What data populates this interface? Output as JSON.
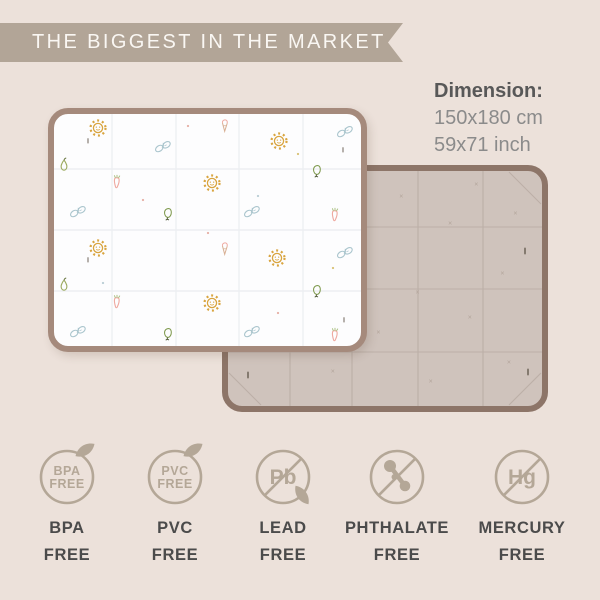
{
  "banner": {
    "title": "THE BIGGEST IN THE MARKET"
  },
  "dimension": {
    "title": "Dimension:",
    "metric": "150x180 cm",
    "imperial": "59x71 inch"
  },
  "mats": {
    "front": {
      "description": "white play mat front side with pastel pattern",
      "pattern_icons": [
        {
          "type": "sun",
          "x": 50,
          "y": 20
        },
        {
          "type": "cone",
          "x": 177,
          "y": 17
        },
        {
          "type": "sun",
          "x": 231,
          "y": 33
        },
        {
          "type": "butterfly",
          "x": 297,
          "y": 24
        },
        {
          "type": "butterfly",
          "x": 115,
          "y": 39
        },
        {
          "type": "pear",
          "x": 16,
          "y": 57
        },
        {
          "type": "balloon",
          "x": 269,
          "y": 64
        },
        {
          "type": "carrot",
          "x": 69,
          "y": 74
        },
        {
          "type": "sun",
          "x": 164,
          "y": 75
        },
        {
          "type": "butterfly",
          "x": 30,
          "y": 104
        },
        {
          "type": "balloon",
          "x": 120,
          "y": 107
        },
        {
          "type": "butterfly",
          "x": 204,
          "y": 104
        },
        {
          "type": "carrot",
          "x": 287,
          "y": 107
        },
        {
          "type": "sun",
          "x": 50,
          "y": 140
        },
        {
          "type": "cone",
          "x": 177,
          "y": 140
        },
        {
          "type": "sun",
          "x": 229,
          "y": 150
        },
        {
          "type": "butterfly",
          "x": 297,
          "y": 145
        },
        {
          "type": "pear",
          "x": 16,
          "y": 177
        },
        {
          "type": "balloon",
          "x": 269,
          "y": 184
        },
        {
          "type": "carrot",
          "x": 69,
          "y": 194
        },
        {
          "type": "sun",
          "x": 164,
          "y": 195
        },
        {
          "type": "butterfly",
          "x": 30,
          "y": 224
        },
        {
          "type": "balloon",
          "x": 120,
          "y": 227
        },
        {
          "type": "butterfly",
          "x": 204,
          "y": 224
        },
        {
          "type": "carrot",
          "x": 287,
          "y": 227
        },
        {
          "type": "dot",
          "x": 140,
          "y": 18,
          "color": "#e7b2a8"
        },
        {
          "type": "dot",
          "x": 250,
          "y": 46,
          "color": "#d9c37a"
        },
        {
          "type": "dot",
          "x": 95,
          "y": 92,
          "color": "#e7b2a8"
        },
        {
          "type": "dot",
          "x": 210,
          "y": 88,
          "color": "#bccfd6"
        },
        {
          "type": "dot",
          "x": 160,
          "y": 125,
          "color": "#e7b2a8"
        },
        {
          "type": "dot",
          "x": 285,
          "y": 160,
          "color": "#d9c37a"
        },
        {
          "type": "dot",
          "x": 55,
          "y": 175,
          "color": "#bccfd6"
        },
        {
          "type": "dot",
          "x": 230,
          "y": 205,
          "color": "#e7b2a8"
        },
        {
          "type": "dash",
          "x": 40,
          "y": 33
        },
        {
          "type": "dash",
          "x": 295,
          "y": 42
        },
        {
          "type": "dash",
          "x": 40,
          "y": 152
        },
        {
          "type": "dash",
          "x": 296,
          "y": 212
        }
      ]
    },
    "back": {
      "description": "taupe play mat back side with fold grid",
      "marks": [
        {
          "t": "x",
          "x": 28,
          "y": 9
        },
        {
          "t": "x",
          "x": 55,
          "y": 13
        },
        {
          "t": "x",
          "x": 78,
          "y": 8
        },
        {
          "t": "x",
          "x": 14,
          "y": 27
        },
        {
          "t": "x",
          "x": 44,
          "y": 31
        },
        {
          "t": "x",
          "x": 70,
          "y": 24
        },
        {
          "t": "x",
          "x": 90,
          "y": 20
        },
        {
          "t": "x",
          "x": 30,
          "y": 46
        },
        {
          "t": "x",
          "x": 60,
          "y": 52
        },
        {
          "t": "x",
          "x": 86,
          "y": 44
        },
        {
          "t": "x",
          "x": 16,
          "y": 64
        },
        {
          "t": "x",
          "x": 48,
          "y": 68
        },
        {
          "t": "x",
          "x": 76,
          "y": 62
        },
        {
          "t": "x",
          "x": 34,
          "y": 84
        },
        {
          "t": "x",
          "x": 64,
          "y": 88
        },
        {
          "t": "x",
          "x": 88,
          "y": 80
        },
        {
          "t": "dash",
          "x": 93,
          "y": 35
        },
        {
          "t": "dash",
          "x": 94,
          "y": 84
        },
        {
          "t": "dash",
          "x": 8,
          "y": 85
        }
      ]
    }
  },
  "badges": [
    {
      "name": "bpa-free",
      "style": "leaf",
      "circle_lines": [
        "BPA",
        "FREE"
      ],
      "label": [
        "BPA",
        "FREE"
      ]
    },
    {
      "name": "pvc-free",
      "style": "leaf",
      "circle_lines": [
        "PVC",
        "FREE"
      ],
      "label": [
        "PVC",
        "FREE"
      ]
    },
    {
      "name": "lead-free",
      "style": "slash-leaf",
      "symbol": "Pb",
      "label": [
        "LEAD",
        "FREE"
      ]
    },
    {
      "name": "phthalate-free",
      "style": "slash-molecule",
      "label": [
        "PHTHALATE",
        "FREE"
      ]
    },
    {
      "name": "mercury-free",
      "style": "slash",
      "symbol": "Hg",
      "label": [
        "MERCURY",
        "FREE"
      ]
    }
  ],
  "colors": {
    "background": "#ece1da",
    "ribbon": "#b2a597",
    "ribbon_text": "#faf7f3",
    "dimension_title": "#585858",
    "dimension_value": "#8b8b8b",
    "mat_front_border": "#a58a7c",
    "mat_front_surface": "#fdfdfe",
    "mat_front_grid": "#edeff2",
    "mat_back_border": "#8d7568",
    "mat_back_surface": "#cfc3bc",
    "mat_back_grid": "#bcafa7",
    "back_mark": "#b3a59b",
    "mark_dark": "#6b6156",
    "badge": "#b4a797",
    "badge_label": "#4b4b4b",
    "icon_sun": "#d9a540",
    "icon_butterfly": "#aac5cd",
    "icon_pear": "#9cab5f",
    "icon_pear_stem": "#6a7742",
    "icon_carrot": "#efa9a0",
    "icon_carrot_leaf": "#a9bf80",
    "icon_balloon": "#7f9a4e",
    "icon_balloon_string": "#49532f",
    "icon_cone": "#d8b094"
  }
}
